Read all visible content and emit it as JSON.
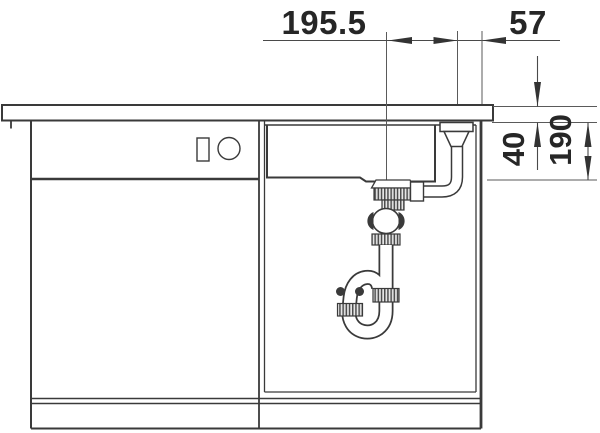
{
  "diagram": {
    "type": "technical installation drawing",
    "subject": "kitchen sink base cabinet front section with drain siphon and outlet dimensions",
    "colors": {
      "background": "#ffffff",
      "line": "#3a3a3a",
      "dimension": "#4a4a4a",
      "text": "#262626"
    },
    "labels": {
      "dim_horizontal_main": "195.5",
      "dim_horizontal_right": "57",
      "dim_vertical_small": "40",
      "dim_vertical_large": "190"
    }
  }
}
